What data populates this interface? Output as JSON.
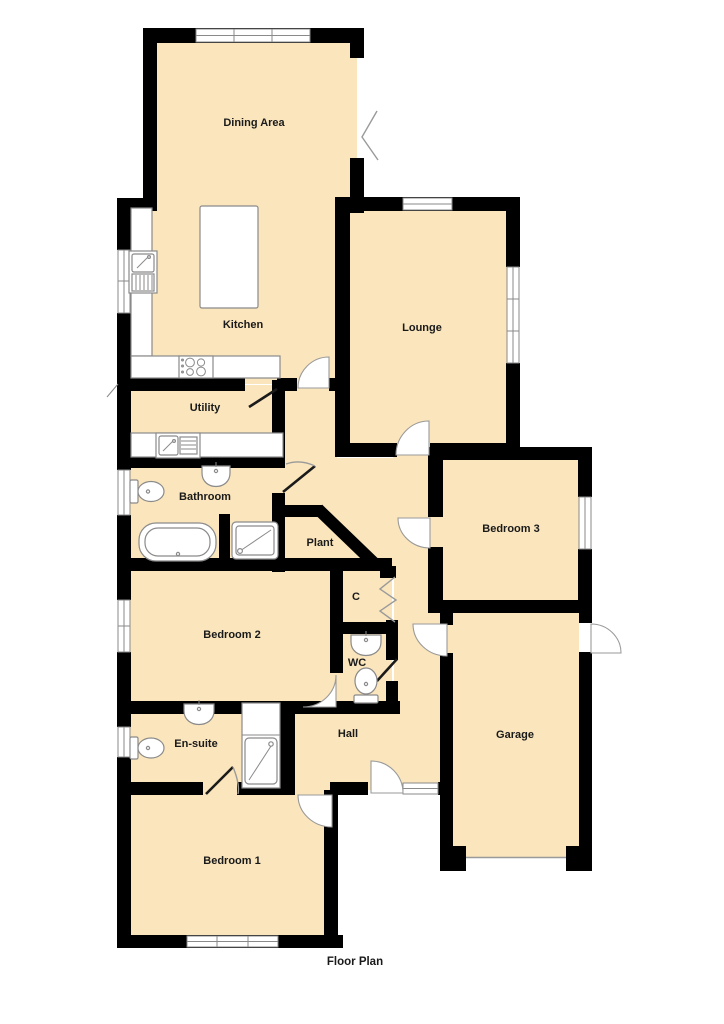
{
  "title": "Floor Plan",
  "colors": {
    "floor": "#FAE5BC",
    "wall": "#000000",
    "fixture": "#8a8a8a",
    "arc": "#9a9a9a",
    "label": "#1a1a1a"
  },
  "rooms": {
    "dining_area": {
      "label": "Dining Area"
    },
    "kitchen": {
      "label": "Kitchen"
    },
    "lounge": {
      "label": "Lounge"
    },
    "utility": {
      "label": "Utility"
    },
    "bathroom": {
      "label": "Bathroom"
    },
    "plant": {
      "label": "Plant"
    },
    "bedroom3": {
      "label": "Bedroom 3"
    },
    "bedroom2": {
      "label": "Bedroom 2"
    },
    "closet": {
      "label": "C"
    },
    "wc": {
      "label": "WC"
    },
    "ensuite": {
      "label": "En-suite"
    },
    "hall": {
      "label": "Hall"
    },
    "garage": {
      "label": "Garage"
    },
    "bedroom1": {
      "label": "Bedroom 1"
    }
  }
}
